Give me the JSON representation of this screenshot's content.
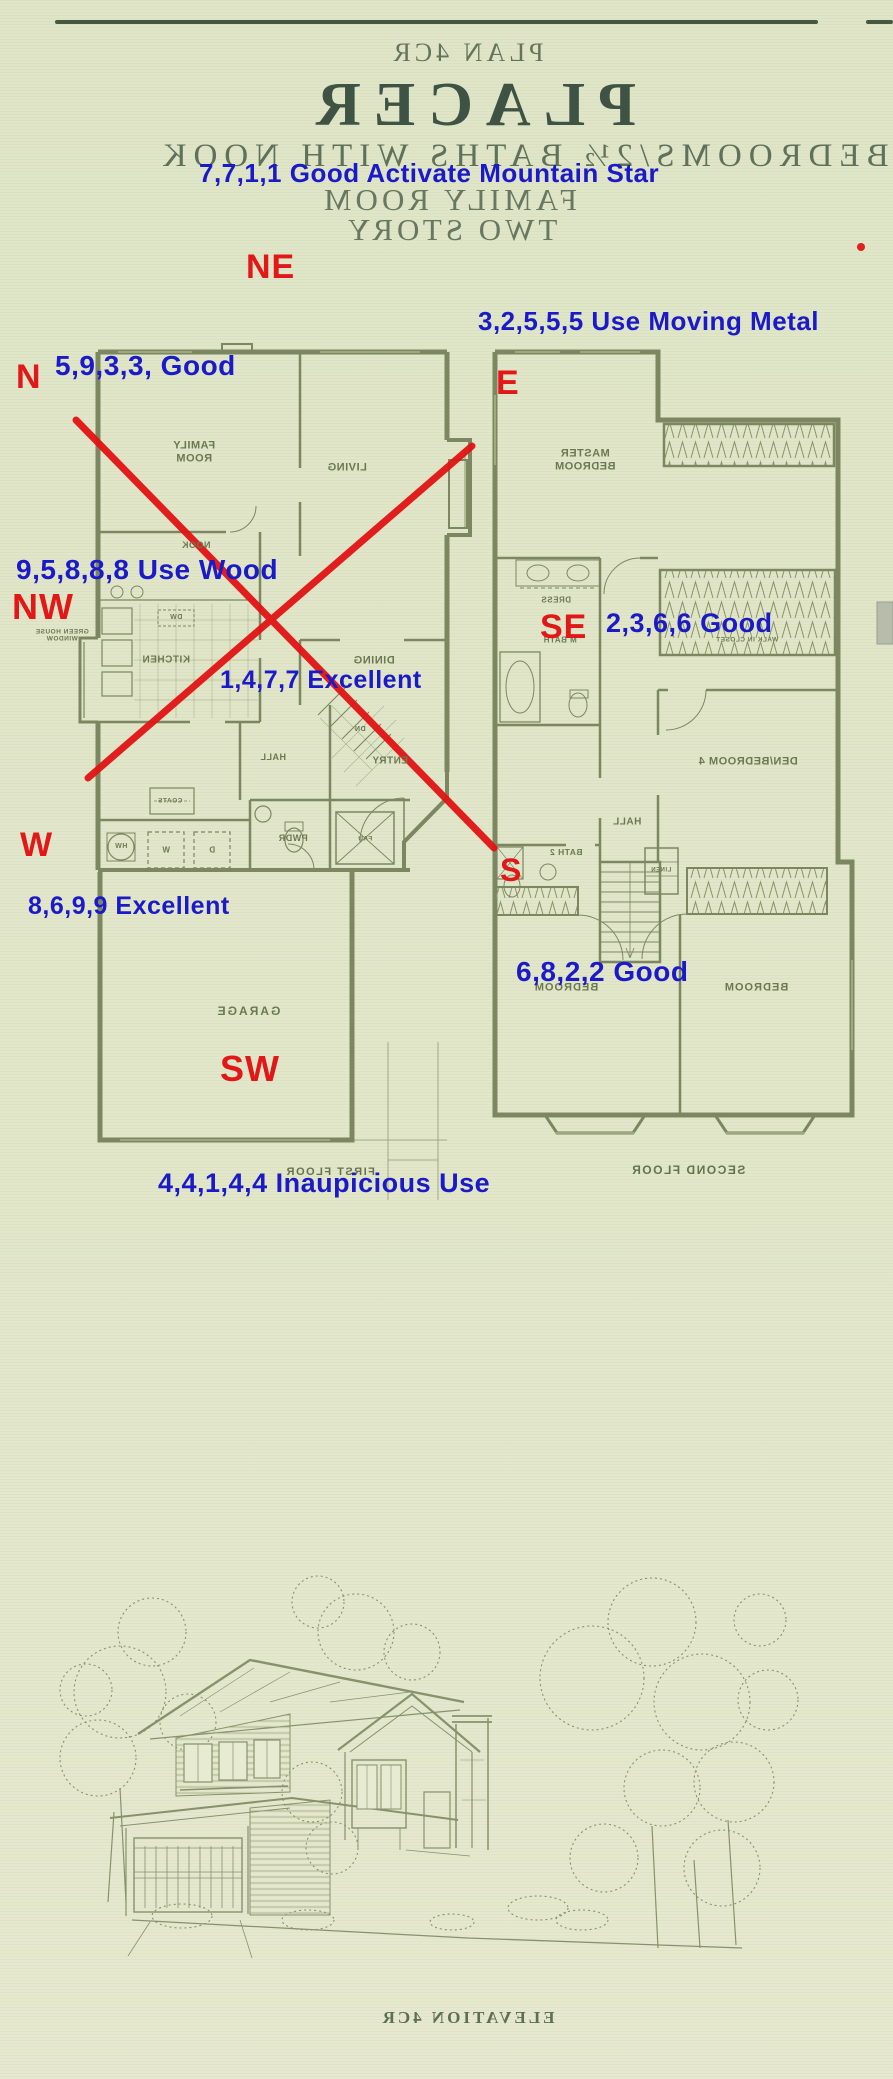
{
  "header": {
    "title_lines": [
      "PLAN 4CR",
      "PLACER",
      "4 BEDROOMS/2½ BATHS WITH NOOK",
      "FAMILY ROOM",
      "TWO STORY"
    ]
  },
  "fengshui": {
    "annotations": [
      "7,7,1,1 Good Activate Mountain Star",
      "3,2,5,5,5  Use Moving Metal",
      "5,9,3,3, Good",
      "9,5,8,8,8 Use Wood",
      "2,3,6,6 Good",
      "1,4,7,7 Excellent",
      "8,6,9,9 Excellent",
      "6,8,2,2 Good",
      "4,4,1,4,4 Inaupicious Use"
    ],
    "directions": [
      "NE",
      "N",
      "E",
      "NW",
      "SE",
      "W",
      "S",
      "SW"
    ]
  },
  "floor1": {
    "caption": "FIRST FLOOR",
    "room_labels": [
      "FAMILY\nROOM",
      "LIVING",
      "NOOK",
      "KITCHEN",
      "DW",
      "DINING",
      "ENTRY",
      "DN",
      "HALL",
      "COATS",
      "PWDR",
      "FAU",
      "HW",
      "W",
      "D",
      "GREEN HOUSE\nWINDOW",
      "GARAGE"
    ]
  },
  "floor2": {
    "caption": "SECOND FLOOR",
    "room_labels": [
      "MASTER\nBEDROOM",
      "DRESS",
      "M BATH",
      "WALK IN CLOSET",
      "DEN/BEDROOM 4",
      "HALL",
      "LINEN",
      "BATH 2",
      "BEDROOM",
      "BEDROOM"
    ]
  },
  "elevation": {
    "caption": "ELEVATION 4CR"
  },
  "colors": {
    "annotation_blue": "#1a1ac8",
    "direction_red": "#e21717",
    "plan_ink": "#7c8762",
    "title_ink": "#3f5344",
    "paper": "#e1e6c9"
  }
}
